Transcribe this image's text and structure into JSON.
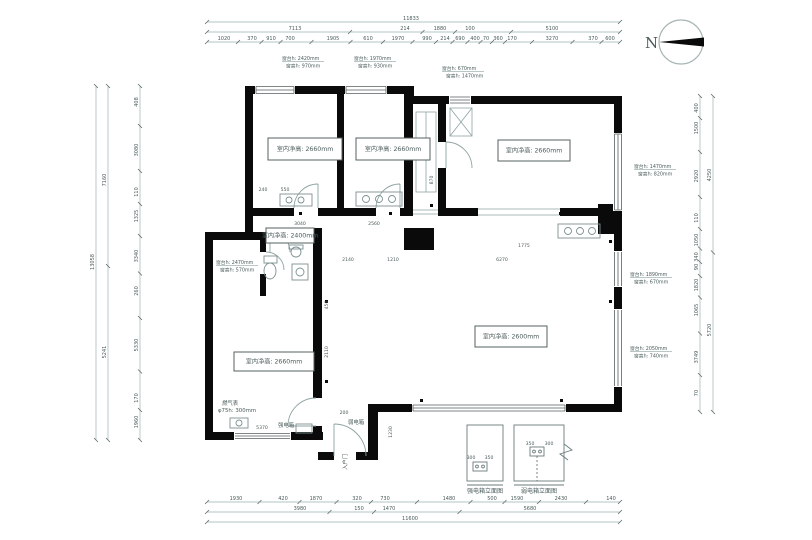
{
  "colors": {
    "wall": "#0a0a0a",
    "thin_line": "#8fa3a3",
    "dim_line": "#9ab0b0",
    "text": "#4a5a5a",
    "background": "#ffffff"
  },
  "north": {
    "label": "N"
  },
  "rooms": [
    {
      "name": "bedroom-1",
      "label": "室内净高: 2660mm",
      "x": 268,
      "y": 138,
      "w": 74,
      "h": 22
    },
    {
      "name": "bedroom-2",
      "label": "室内净高: 2660mm",
      "x": 356,
      "y": 138,
      "w": 74,
      "h": 22
    },
    {
      "name": "bedroom-3",
      "label": "室内净高: 2660mm",
      "x": 498,
      "y": 140,
      "w": 72,
      "h": 21
    },
    {
      "name": "bathroom",
      "label": "室内净高: 2400mm",
      "x": 266,
      "y": 228,
      "w": 48,
      "h": 15
    },
    {
      "name": "kitchen",
      "label": "室内净高: 2660mm",
      "x": 234,
      "y": 352,
      "w": 80,
      "h": 19
    },
    {
      "name": "living",
      "label": "室内净高: 2600mm",
      "x": 475,
      "y": 326,
      "w": 72,
      "h": 21
    }
  ],
  "window_annotations": [
    {
      "l1": "窗台h: 2420mm",
      "l2": "窗高h: 970mm",
      "x": 282,
      "y": 60
    },
    {
      "l1": "窗台h: 1970mm",
      "l2": "窗高h: 930mm",
      "x": 354,
      "y": 60
    },
    {
      "l1": "窗台h: 670mm",
      "l2": "窗高h: 1470mm",
      "x": 442,
      "y": 70
    },
    {
      "l1": "窗台h: 2470mm",
      "l2": "窗高h: 570mm",
      "x": 216,
      "y": 264
    },
    {
      "l1": "窗台h: 1470mm",
      "l2": "窗高h: 820mm",
      "x": 634,
      "y": 168
    },
    {
      "l1": "窗台h: 1890mm",
      "l2": "窗高h: 670mm",
      "x": 630,
      "y": 276
    },
    {
      "l1": "窗台h: 2050mm",
      "l2": "窗高h: 740mm",
      "x": 630,
      "y": 350
    }
  ],
  "misc_labels": [
    {
      "t": "燃气表",
      "x": 222,
      "y": 405
    },
    {
      "t": "φ75h: 300mm",
      "x": 218,
      "y": 412
    },
    {
      "t": "强电箱",
      "x": 278,
      "y": 427
    },
    {
      "t": "弱电箱",
      "x": 348,
      "y": 424
    },
    {
      "t": "入户门",
      "x": 347,
      "y": 470,
      "rot": -90
    }
  ],
  "interior_dims": [
    {
      "t": "240",
      "x": 263,
      "y": 191
    },
    {
      "t": "550",
      "x": 285,
      "y": 191
    },
    {
      "t": "3040",
      "x": 300,
      "y": 225
    },
    {
      "t": "2560",
      "x": 374,
      "y": 225
    },
    {
      "t": "2140",
      "x": 348,
      "y": 261
    },
    {
      "t": "1210",
      "x": 393,
      "y": 261
    },
    {
      "t": "6270",
      "x": 502,
      "y": 261
    },
    {
      "t": "1775",
      "x": 524,
      "y": 247
    },
    {
      "t": "870",
      "x": 433,
      "y": 180,
      "rot": -90
    },
    {
      "t": "450",
      "x": 328,
      "y": 305,
      "rot": -90
    },
    {
      "t": "2110",
      "x": 328,
      "y": 352,
      "rot": -90
    },
    {
      "t": "5370",
      "x": 262,
      "y": 429
    },
    {
      "t": "200",
      "x": 344,
      "y": 414
    },
    {
      "t": "1230",
      "x": 392,
      "y": 432,
      "rot": -90
    },
    {
      "t": "300",
      "x": 471,
      "y": 459
    },
    {
      "t": "350",
      "x": 489,
      "y": 459
    },
    {
      "t": "350",
      "x": 530,
      "y": 445
    },
    {
      "t": "300",
      "x": 549,
      "y": 445
    }
  ],
  "detail_blocks": {
    "captions": [
      "强电箱立面图",
      "弱电箱立面图"
    ]
  },
  "chains": [
    {
      "name": "top-total",
      "dir": "h",
      "c": 22,
      "ext": [
        207,
        620
      ],
      "labels": [
        {
          "t": "11833",
          "p": 411
        }
      ]
    },
    {
      "name": "top-mid",
      "dir": "h",
      "c": 32,
      "ext": [
        207,
        620
      ],
      "labels": [
        {
          "t": "7113",
          "p": 295
        },
        {
          "t": "214",
          "p": 405
        },
        {
          "t": "1880",
          "p": 440
        },
        {
          "t": "100",
          "p": 470
        },
        {
          "t": "5100",
          "p": 552
        }
      ]
    },
    {
      "name": "top-detail",
      "dir": "h",
      "c": 42,
      "ext": [
        207,
        620
      ],
      "labels": [
        {
          "t": "1020",
          "p": 224
        },
        {
          "t": "370",
          "p": 252
        },
        {
          "t": "910",
          "p": 271
        },
        {
          "t": "700",
          "p": 290
        },
        {
          "t": "1905",
          "p": 333
        },
        {
          "t": "610",
          "p": 368
        },
        {
          "t": "1970",
          "p": 398
        },
        {
          "t": "990",
          "p": 427
        },
        {
          "t": "214",
          "p": 445
        },
        {
          "t": "690",
          "p": 460
        },
        {
          "t": "400",
          "p": 475
        },
        {
          "t": "70",
          "p": 486
        },
        {
          "t": "360",
          "p": 498
        },
        {
          "t": "170",
          "p": 512
        },
        {
          "t": "3270",
          "p": 552
        },
        {
          "t": "370",
          "p": 593
        },
        {
          "t": "600",
          "p": 610
        }
      ]
    },
    {
      "name": "bottom-detail",
      "dir": "h",
      "c": 502,
      "ext": [
        207,
        620
      ],
      "labels": [
        {
          "t": "1930",
          "p": 236
        },
        {
          "t": "420",
          "p": 283
        },
        {
          "t": "1870",
          "p": 316
        },
        {
          "t": "320",
          "p": 357
        },
        {
          "t": "730",
          "p": 385
        },
        {
          "t": "1480",
          "p": 449
        },
        {
          "t": "500",
          "p": 492
        },
        {
          "t": "1590",
          "p": 517
        },
        {
          "t": "2430",
          "p": 561
        },
        {
          "t": "140",
          "p": 611
        }
      ]
    },
    {
      "name": "bottom-mid",
      "dir": "h",
      "c": 512,
      "ext": [
        207,
        620
      ],
      "labels": [
        {
          "t": "3980",
          "p": 300
        },
        {
          "t": "150",
          "p": 359
        },
        {
          "t": "1470",
          "p": 389
        },
        {
          "t": "5680",
          "p": 530
        }
      ]
    },
    {
      "name": "bottom-total",
      "dir": "h",
      "c": 522,
      "ext": [
        207,
        620
      ],
      "labels": [
        {
          "t": "11600",
          "p": 410
        }
      ]
    },
    {
      "name": "left-total",
      "dir": "v",
      "c": 96,
      "ext": [
        86,
        440
      ],
      "labels": [
        {
          "t": "13058",
          "p": 262
        }
      ]
    },
    {
      "name": "left-mid",
      "dir": "v",
      "c": 108,
      "ext": [
        86,
        440
      ],
      "labels": [
        {
          "t": "7160",
          "p": 180
        },
        {
          "t": "5241",
          "p": 352
        }
      ]
    },
    {
      "name": "left-detail",
      "dir": "v",
      "c": 140,
      "ext": [
        86,
        440
      ],
      "labels": [
        {
          "t": "408",
          "p": 102
        },
        {
          "t": "3080",
          "p": 150
        },
        {
          "t": "110",
          "p": 192
        },
        {
          "t": "1325",
          "p": 216
        },
        {
          "t": "3340",
          "p": 256
        },
        {
          "t": "260",
          "p": 291
        },
        {
          "t": "5330",
          "p": 345
        },
        {
          "t": "170",
          "p": 398
        },
        {
          "t": "1960",
          "p": 422
        }
      ]
    },
    {
      "name": "right-detail",
      "dir": "v",
      "c": 700,
      "ext": [
        96,
        412
      ],
      "labels": [
        {
          "t": "400",
          "p": 108
        },
        {
          "t": "1500",
          "p": 128
        },
        {
          "t": "2920",
          "p": 176
        },
        {
          "t": "110",
          "p": 218
        },
        {
          "t": "1050",
          "p": 240
        },
        {
          "t": "340",
          "p": 257
        },
        {
          "t": "90",
          "p": 267
        },
        {
          "t": "1820",
          "p": 285
        },
        {
          "t": "1065",
          "p": 310
        },
        {
          "t": "3749",
          "p": 357
        },
        {
          "t": "70",
          "p": 393
        }
      ]
    },
    {
      "name": "right-total",
      "dir": "v",
      "c": 713,
      "ext": [
        96,
        412
      ],
      "labels": [
        {
          "t": "4250",
          "p": 175
        },
        {
          "t": "5720",
          "p": 330
        }
      ]
    }
  ]
}
